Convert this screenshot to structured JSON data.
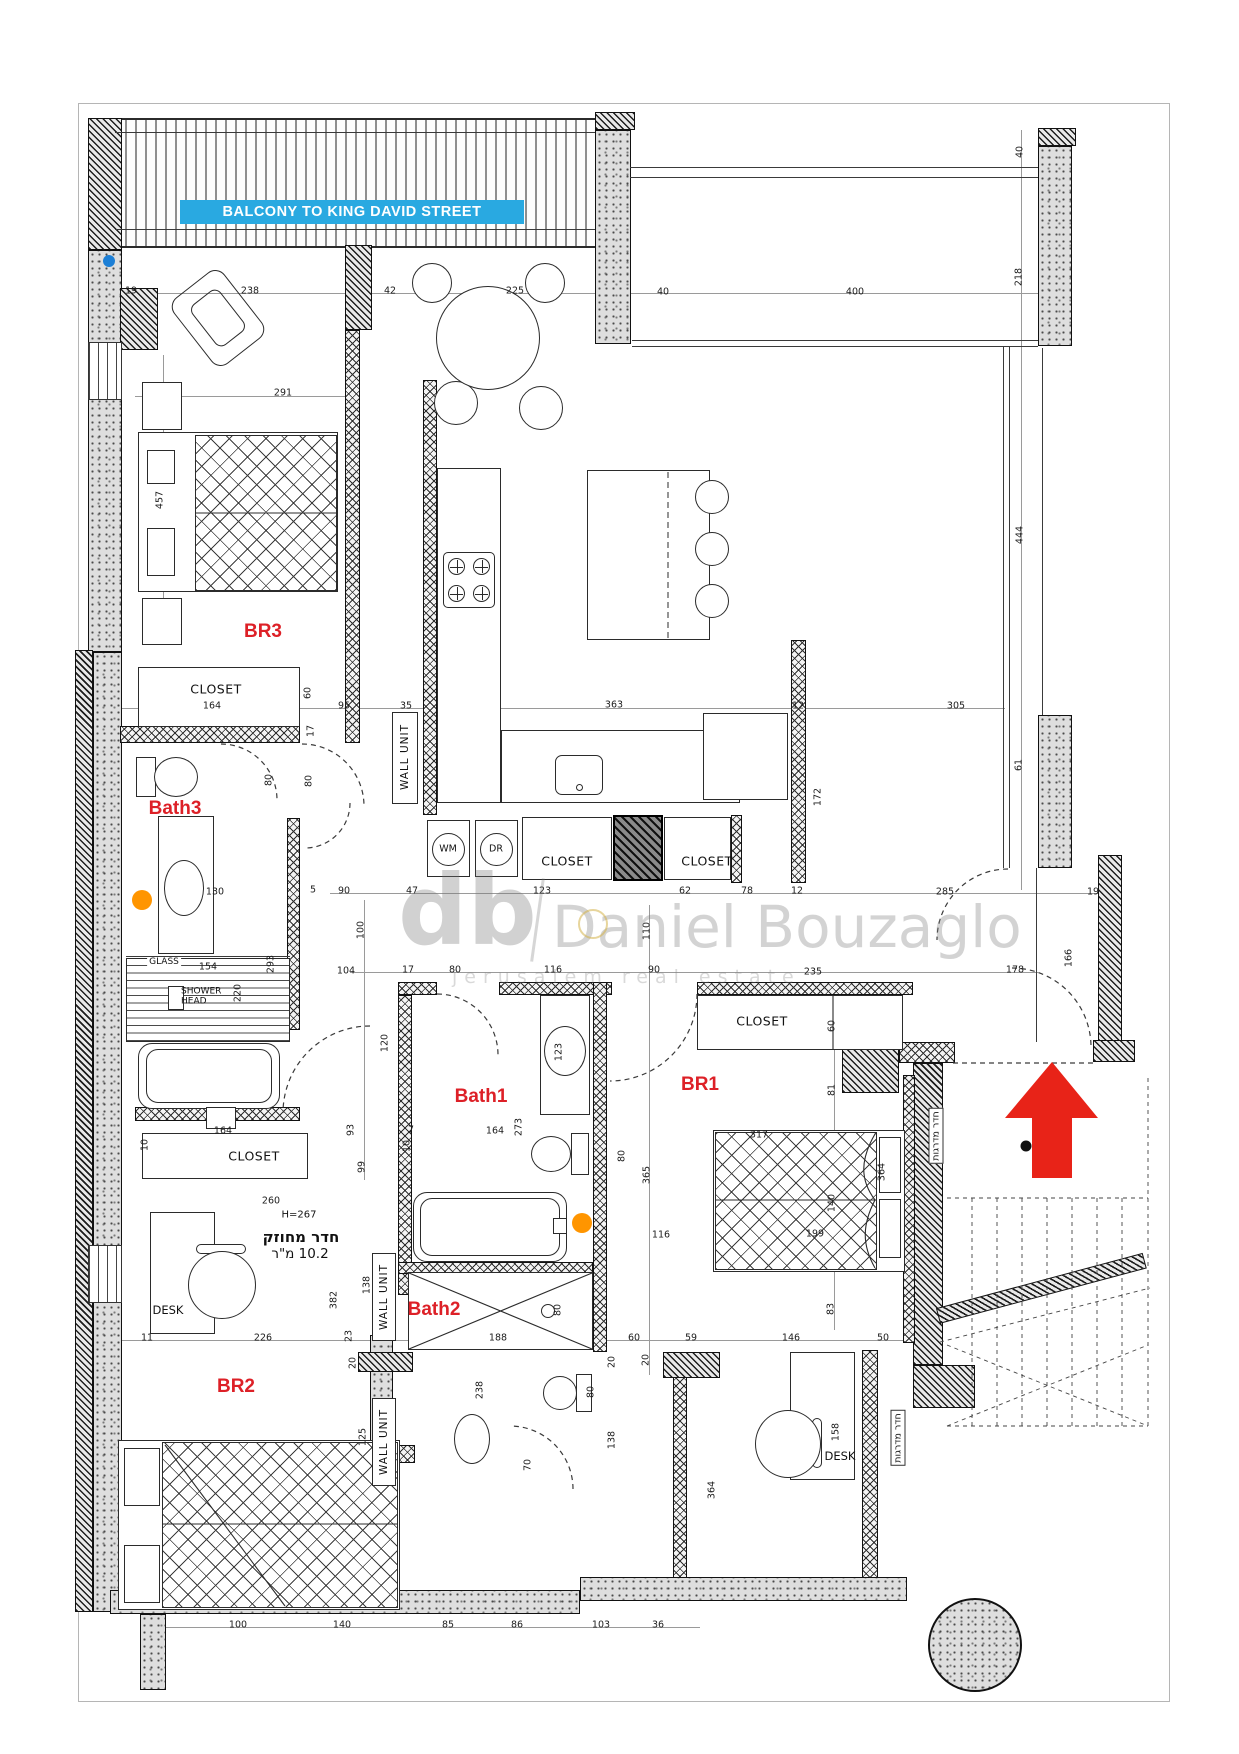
{
  "balcony": {
    "label": "BALCONY TO KING DAVID STREET"
  },
  "watermark": {
    "logo": "db",
    "name": "Daniel Bouzaglo",
    "subtitle": "jerusalem real estate"
  },
  "colors": {
    "accent_blue": "#29a9e1",
    "room_red": "#dd2027",
    "arrow_red": "#e82318",
    "marker_orange": "#ff9500",
    "marker_blue": "#1c7fd6"
  },
  "rooms": [
    {
      "t": "BR3",
      "x": 263,
      "y": 632
    },
    {
      "t": "Bath3",
      "x": 175,
      "y": 809
    },
    {
      "t": "Bath1",
      "x": 481,
      "y": 1097
    },
    {
      "t": "BR1",
      "x": 700,
      "y": 1085
    },
    {
      "t": "Bath2",
      "x": 434,
      "y": 1310
    },
    {
      "t": "BR2",
      "x": 236,
      "y": 1387
    }
  ],
  "labels": [
    {
      "k": "closet",
      "t": "CLOSET",
      "x": 216,
      "y": 689
    },
    {
      "k": "closet",
      "t": "CLOSET",
      "x": 567,
      "y": 861
    },
    {
      "k": "closet",
      "t": "CLOSET",
      "x": 707,
      "y": 861
    },
    {
      "k": "closet",
      "t": "CLOSET",
      "x": 762,
      "y": 1021
    },
    {
      "k": "closet",
      "t": "CLOSET",
      "x": 254,
      "y": 1156
    },
    {
      "k": "wu",
      "t": "WALL UNIT",
      "x": 405,
      "y": 757
    },
    {
      "k": "wu",
      "t": "WALL UNIT",
      "x": 384,
      "y": 1297
    },
    {
      "k": "wu",
      "t": "WALL UNIT",
      "x": 384,
      "y": 1442
    },
    {
      "k": "app",
      "t": "WM",
      "x": 448,
      "y": 849
    },
    {
      "k": "app",
      "t": "DR",
      "x": 496,
      "y": 849
    },
    {
      "k": "desk",
      "t": "DESK",
      "x": 168,
      "y": 1310
    },
    {
      "k": "desk",
      "t": "DESK",
      "x": 840,
      "y": 1456
    },
    {
      "k": "glass",
      "t": "GLASS",
      "x": 164,
      "y": 962
    },
    {
      "k": "shower",
      "t": "SHOWER HEAD",
      "x": 207,
      "y": 997
    },
    {
      "k": "h",
      "t": "H=267",
      "x": 299,
      "y": 1215
    },
    {
      "k": "heb1",
      "t": "חדר מחוזק",
      "x": 301,
      "y": 1237
    },
    {
      "k": "heb2",
      "t": "10.2 מ\"ר",
      "x": 300,
      "y": 1254
    },
    {
      "k": "hebv",
      "t": "חדר מדרגות",
      "x": 936,
      "y": 1136
    },
    {
      "k": "hebv",
      "t": "חדר מדרגות",
      "x": 898,
      "y": 1438
    }
  ],
  "dims": [
    {
      "t": "19",
      "x": 131,
      "y": 291
    },
    {
      "t": "238",
      "x": 250,
      "y": 291
    },
    {
      "t": "42",
      "x": 390,
      "y": 291
    },
    {
      "t": "225",
      "x": 515,
      "y": 291
    },
    {
      "t": "40",
      "x": 663,
      "y": 292
    },
    {
      "t": "400",
      "x": 855,
      "y": 292
    },
    {
      "t": "40",
      "x": 1020,
      "y": 152,
      "r": 1
    },
    {
      "t": "218",
      "x": 1019,
      "y": 277,
      "r": 1
    },
    {
      "t": "291",
      "x": 283,
      "y": 393
    },
    {
      "t": "457",
      "x": 160,
      "y": 500,
      "r": 1
    },
    {
      "t": "164",
      "x": 212,
      "y": 706
    },
    {
      "t": "60",
      "x": 308,
      "y": 693,
      "r": 1
    },
    {
      "t": "95",
      "x": 344,
      "y": 706
    },
    {
      "t": "35",
      "x": 406,
      "y": 706
    },
    {
      "t": "363",
      "x": 614,
      "y": 705
    },
    {
      "t": "12",
      "x": 798,
      "y": 706
    },
    {
      "t": "305",
      "x": 956,
      "y": 706
    },
    {
      "t": "172",
      "x": 818,
      "y": 797,
      "r": 1
    },
    {
      "t": "444",
      "x": 1020,
      "y": 535,
      "r": 1
    },
    {
      "t": "17",
      "x": 311,
      "y": 731,
      "r": 1
    },
    {
      "t": "80",
      "x": 269,
      "y": 780,
      "r": 1
    },
    {
      "t": "80",
      "x": 309,
      "y": 781,
      "r": 1
    },
    {
      "t": "61",
      "x": 1019,
      "y": 765,
      "r": 1
    },
    {
      "t": "90",
      "x": 344,
      "y": 891
    },
    {
      "t": "5",
      "x": 313,
      "y": 890
    },
    {
      "t": "130",
      "x": 215,
      "y": 892
    },
    {
      "t": "47",
      "x": 412,
      "y": 891
    },
    {
      "t": "123",
      "x": 542,
      "y": 891
    },
    {
      "t": "62",
      "x": 685,
      "y": 891
    },
    {
      "t": "78",
      "x": 747,
      "y": 891
    },
    {
      "t": "12",
      "x": 797,
      "y": 891
    },
    {
      "t": "285",
      "x": 945,
      "y": 892
    },
    {
      "t": "19",
      "x": 1093,
      "y": 892
    },
    {
      "t": "100",
      "x": 361,
      "y": 930,
      "r": 1
    },
    {
      "t": "154",
      "x": 208,
      "y": 967
    },
    {
      "t": "293",
      "x": 271,
      "y": 964,
      "r": 1
    },
    {
      "t": "220",
      "x": 238,
      "y": 993,
      "r": 1
    },
    {
      "t": "104",
      "x": 346,
      "y": 971
    },
    {
      "t": "17",
      "x": 408,
      "y": 970
    },
    {
      "t": "80",
      "x": 455,
      "y": 970
    },
    {
      "t": "116",
      "x": 553,
      "y": 970
    },
    {
      "t": "90",
      "x": 654,
      "y": 970
    },
    {
      "t": "235",
      "x": 813,
      "y": 972
    },
    {
      "t": "178",
      "x": 1015,
      "y": 970
    },
    {
      "t": "166",
      "x": 1069,
      "y": 958,
      "r": 1
    },
    {
      "t": "110",
      "x": 647,
      "y": 931,
      "r": 1
    },
    {
      "t": "120",
      "x": 385,
      "y": 1043,
      "r": 1
    },
    {
      "t": "123",
      "x": 559,
      "y": 1052,
      "r": 1
    },
    {
      "t": "60",
      "x": 832,
      "y": 1026,
      "r": 1
    },
    {
      "t": "81",
      "x": 832,
      "y": 1090,
      "r": 1
    },
    {
      "t": "317",
      "x": 759,
      "y": 1135
    },
    {
      "t": "364",
      "x": 882,
      "y": 1172,
      "r": 1
    },
    {
      "t": "365",
      "x": 647,
      "y": 1175,
      "r": 1
    },
    {
      "t": "140",
      "x": 832,
      "y": 1203,
      "r": 1
    },
    {
      "t": "199",
      "x": 815,
      "y": 1234
    },
    {
      "t": "116",
      "x": 661,
      "y": 1235
    },
    {
      "t": "164",
      "x": 495,
      "y": 1131
    },
    {
      "t": "273",
      "x": 519,
      "y": 1127,
      "r": 1
    },
    {
      "t": "99",
      "x": 362,
      "y": 1167,
      "r": 1
    },
    {
      "t": "93",
      "x": 351,
      "y": 1130,
      "r": 1
    },
    {
      "t": "7",
      "x": 411,
      "y": 1130
    },
    {
      "t": "10",
      "x": 407,
      "y": 1146,
      "r": 1
    },
    {
      "t": "164",
      "x": 223,
      "y": 1131
    },
    {
      "t": "10",
      "x": 145,
      "y": 1145,
      "r": 1
    },
    {
      "t": "260",
      "x": 271,
      "y": 1201
    },
    {
      "t": "80",
      "x": 622,
      "y": 1156,
      "r": 1
    },
    {
      "t": "226",
      "x": 263,
      "y": 1338
    },
    {
      "t": "11",
      "x": 147,
      "y": 1338
    },
    {
      "t": "382",
      "x": 334,
      "y": 1300,
      "r": 1
    },
    {
      "t": "138",
      "x": 367,
      "y": 1285,
      "r": 1
    },
    {
      "t": "23",
      "x": 349,
      "y": 1336,
      "r": 1
    },
    {
      "t": "20",
      "x": 353,
      "y": 1363,
      "r": 1
    },
    {
      "t": "125",
      "x": 363,
      "y": 1437,
      "r": 1
    },
    {
      "t": "83",
      "x": 831,
      "y": 1309,
      "r": 1
    },
    {
      "t": "60",
      "x": 634,
      "y": 1338
    },
    {
      "t": "59",
      "x": 691,
      "y": 1338
    },
    {
      "t": "146",
      "x": 791,
      "y": 1338
    },
    {
      "t": "50",
      "x": 883,
      "y": 1338
    },
    {
      "t": "20",
      "x": 646,
      "y": 1360,
      "r": 1
    },
    {
      "t": "158",
      "x": 836,
      "y": 1432,
      "r": 1
    },
    {
      "t": "188",
      "x": 498,
      "y": 1338
    },
    {
      "t": "80",
      "x": 558,
      "y": 1310,
      "r": 1
    },
    {
      "t": "238",
      "x": 480,
      "y": 1390,
      "r": 1
    },
    {
      "t": "80",
      "x": 591,
      "y": 1392,
      "r": 1
    },
    {
      "t": "70",
      "x": 528,
      "y": 1465,
      "r": 1
    },
    {
      "t": "138",
      "x": 612,
      "y": 1440,
      "r": 1
    },
    {
      "t": "20",
      "x": 612,
      "y": 1362,
      "r": 1
    },
    {
      "t": "364",
      "x": 712,
      "y": 1490,
      "r": 1
    },
    {
      "t": "100",
      "x": 238,
      "y": 1625
    },
    {
      "t": "140",
      "x": 342,
      "y": 1625
    },
    {
      "t": "85",
      "x": 448,
      "y": 1625
    },
    {
      "t": "86",
      "x": 517,
      "y": 1625
    },
    {
      "t": "103",
      "x": 601,
      "y": 1625
    },
    {
      "t": "36",
      "x": 658,
      "y": 1625
    }
  ],
  "plan": {
    "walls": [
      {
        "p": "d",
        "x": 88,
        "y": 118,
        "w": 34,
        "h": 132
      },
      {
        "p": "s",
        "x": 88,
        "y": 250,
        "w": 34,
        "h": 402
      },
      {
        "p": "d",
        "x": 75,
        "y": 650,
        "w": 18,
        "h": 962
      },
      {
        "p": "s",
        "x": 93,
        "y": 652,
        "w": 29,
        "h": 960
      },
      {
        "p": "w",
        "x": 88,
        "y": 342,
        "w": 34,
        "h": 58
      },
      {
        "p": "w",
        "x": 88,
        "y": 1245,
        "w": 34,
        "h": 58
      },
      {
        "p": "d",
        "x": 120,
        "y": 288,
        "w": 38,
        "h": 62
      },
      {
        "p": "d",
        "x": 595,
        "y": 112,
        "w": 40,
        "h": 18
      },
      {
        "p": "s",
        "x": 595,
        "y": 130,
        "w": 36,
        "h": 214
      },
      {
        "p": "d",
        "x": 1038,
        "y": 128,
        "w": 38,
        "h": 18
      },
      {
        "p": "s",
        "x": 1038,
        "y": 146,
        "w": 34,
        "h": 200
      },
      {
        "p": "s",
        "x": 1038,
        "y": 715,
        "w": 34,
        "h": 153
      },
      {
        "p": "d",
        "x": 345,
        "y": 245,
        "w": 27,
        "h": 85
      },
      {
        "p": "c",
        "x": 345,
        "y": 330,
        "w": 15,
        "h": 413
      },
      {
        "p": "c",
        "x": 120,
        "y": 726,
        "w": 180,
        "h": 17
      },
      {
        "p": "c",
        "x": 287,
        "y": 818,
        "w": 13,
        "h": 212
      },
      {
        "p": "c",
        "x": 423,
        "y": 380,
        "w": 14,
        "h": 435
      },
      {
        "p": "c",
        "x": 791,
        "y": 640,
        "w": 15,
        "h": 243
      },
      {
        "p": "c",
        "x": 731,
        "y": 815,
        "w": 11,
        "h": 68
      },
      {
        "p": "c",
        "x": 398,
        "y": 982,
        "w": 39,
        "h": 13
      },
      {
        "p": "c",
        "x": 499,
        "y": 982,
        "w": 113,
        "h": 13
      },
      {
        "p": "c",
        "x": 697,
        "y": 982,
        "w": 216,
        "h": 13
      },
      {
        "p": "c",
        "x": 398,
        "y": 995,
        "w": 14,
        "h": 300
      },
      {
        "p": "c",
        "x": 593,
        "y": 982,
        "w": 14,
        "h": 370
      },
      {
        "p": "c",
        "x": 673,
        "y": 1352,
        "w": 14,
        "h": 228
      },
      {
        "p": "d",
        "x": 663,
        "y": 1352,
        "w": 57,
        "h": 26
      },
      {
        "p": "c",
        "x": 398,
        "y": 1262,
        "w": 195,
        "h": 12
      },
      {
        "p": "c",
        "x": 135,
        "y": 1107,
        "w": 165,
        "h": 14
      },
      {
        "p": "s",
        "x": 370,
        "y": 1335,
        "w": 23,
        "h": 278
      },
      {
        "p": "d",
        "x": 358,
        "y": 1352,
        "w": 55,
        "h": 20
      },
      {
        "p": "c",
        "x": 330,
        "y": 1445,
        "w": 85,
        "h": 18
      },
      {
        "p": "d",
        "x": 913,
        "y": 1063,
        "w": 30,
        "h": 302
      },
      {
        "p": "d",
        "x": 913,
        "y": 1365,
        "w": 62,
        "h": 43
      },
      {
        "p": "c",
        "x": 862,
        "y": 1350,
        "w": 16,
        "h": 230
      },
      {
        "p": "c",
        "x": 903,
        "y": 1075,
        "w": 12,
        "h": 268
      },
      {
        "p": "d",
        "x": 1098,
        "y": 855,
        "w": 24,
        "h": 187
      },
      {
        "p": "d",
        "x": 1093,
        "y": 1040,
        "w": 42,
        "h": 22
      },
      {
        "p": "d",
        "x": 842,
        "y": 1042,
        "w": 57,
        "h": 51
      },
      {
        "p": "c",
        "x": 899,
        "y": 1042,
        "w": 56,
        "h": 21
      },
      {
        "p": "s",
        "x": 110,
        "y": 1590,
        "w": 470,
        "h": 24
      },
      {
        "p": "s",
        "x": 580,
        "y": 1577,
        "w": 327,
        "h": 24
      },
      {
        "p": "s",
        "x": 140,
        "y": 1614,
        "w": 26,
        "h": 76
      },
      {
        "p": "d",
        "x": 938,
        "y": 1308,
        "w": 214,
        "h": 16,
        "r": -15
      },
      {
        "p": "k",
        "x": 613,
        "y": 815,
        "w": 50,
        "h": 66
      }
    ],
    "lines": [
      {
        "x": 630,
        "y": 167,
        "w": 408,
        "h": 1
      },
      {
        "x": 630,
        "y": 177,
        "w": 408,
        "h": 1
      },
      {
        "x": 632,
        "y": 340,
        "w": 406,
        "h": 1
      },
      {
        "x": 632,
        "y": 346,
        "w": 406,
        "h": 1
      },
      {
        "x": 1003,
        "y": 346,
        "w": 1,
        "h": 522
      },
      {
        "x": 1009,
        "y": 346,
        "w": 1,
        "h": 522
      },
      {
        "x": 1042,
        "y": 348,
        "w": 1,
        "h": 367
      },
      {
        "x": 1036,
        "y": 868,
        "w": 1,
        "h": 174
      },
      {
        "x": 115,
        "y": 132,
        "w": 480,
        "h": 1
      },
      {
        "x": 115,
        "y": 229,
        "w": 480,
        "h": 1
      },
      {
        "x": 126,
        "y": 956,
        "w": 164,
        "h": 1
      },
      {
        "x": 120,
        "y": 293,
        "w": 918,
        "h": 1,
        "c": 1
      },
      {
        "x": 120,
        "y": 708,
        "w": 885,
        "h": 1,
        "c": 1
      },
      {
        "x": 330,
        "y": 893,
        "w": 770,
        "h": 1,
        "c": 1
      },
      {
        "x": 350,
        "y": 972,
        "w": 688,
        "h": 1,
        "c": 1
      },
      {
        "x": 85,
        "y": 1340,
        "w": 825,
        "h": 1,
        "c": 1
      },
      {
        "x": 150,
        "y": 1627,
        "w": 550,
        "h": 1,
        "c": 1
      },
      {
        "x": 1021,
        "y": 130,
        "w": 1,
        "h": 760,
        "c": 1
      },
      {
        "x": 834,
        "y": 1000,
        "w": 1,
        "h": 330,
        "c": 1
      },
      {
        "x": 649,
        "y": 905,
        "w": 1,
        "h": 470,
        "c": 1
      },
      {
        "x": 364,
        "y": 900,
        "w": 1,
        "h": 280,
        "c": 1
      },
      {
        "x": 163,
        "y": 355,
        "w": 1,
        "h": 290,
        "c": 1
      },
      {
        "x": 135,
        "y": 396,
        "w": 210,
        "h": 1,
        "c": 1
      }
    ]
  }
}
